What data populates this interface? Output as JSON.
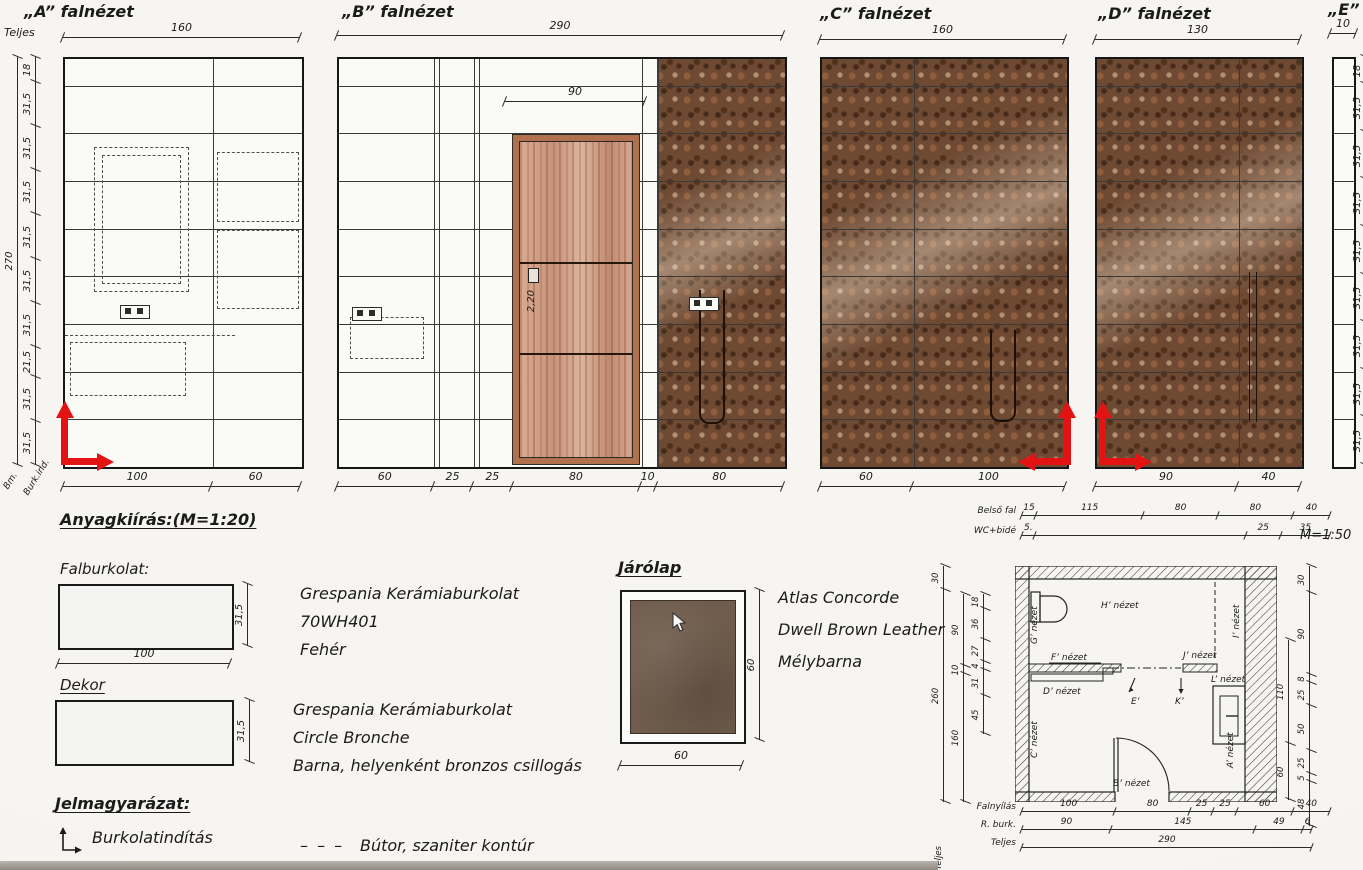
{
  "colors": {
    "accent_red": "#e31313",
    "mosaic_brown": "#6e4a33",
    "wood_tan": "#cf9c82",
    "floor_brown": "#6f5c4c",
    "ink": "#222222"
  },
  "views": {
    "a": {
      "title": "„A” falnézet",
      "teljes_label": "Teljes",
      "width_chain": [
        "160"
      ],
      "height_chain": [
        "270"
      ],
      "height_segments": [
        "18",
        "31,5",
        "31,5",
        "31,5",
        "31,5",
        "31,5",
        "31,5",
        "21,5",
        "31,5",
        "31,5"
      ],
      "bottom_chain": [
        "100",
        "60"
      ],
      "corner_label_1": "Bm.",
      "corner_label_2": "Burk.ind."
    },
    "b": {
      "title": "„B” falnézet",
      "width_chain": [
        "290"
      ],
      "door_width_chain": [
        "90"
      ],
      "door_height_label": "2,20",
      "bottom_chain": [
        "60",
        "25",
        "25",
        "80",
        "10",
        "80"
      ]
    },
    "c": {
      "title": "„C” falnézet",
      "width_chain": [
        "160"
      ],
      "bottom_chain": [
        "60",
        "100"
      ]
    },
    "d": {
      "title": "„D” falnézet",
      "width_chain": [
        "130"
      ],
      "bottom_chain": [
        "90",
        "40"
      ]
    },
    "e": {
      "title": "„E”",
      "width_chain": [
        "10"
      ],
      "height_segments": [
        "18",
        "31,5",
        "31,5",
        "31,5",
        "31,5",
        "31,5",
        "31,5",
        "31,5",
        "31,5"
      ]
    }
  },
  "materials": {
    "section_title": "Anyagkiírás:(M=1:20)",
    "wall_tile_label": "Falburkolat:",
    "wall_tile_width_chain": [
      "100"
    ],
    "wall_tile_height_chain": [
      "31,5"
    ],
    "wall_tile_desc": [
      "Grespania Kerámiaburkolat",
      "70WH401",
      "Fehér"
    ],
    "decor_label": "Dekor",
    "decor_height_chain": [
      "31,5"
    ],
    "decor_desc": [
      "Grespania Kerámiaburkolat",
      "Circle Bronche",
      "Barna, helyenként bronzos csillogás"
    ]
  },
  "floor_tile": {
    "title": "Járólap",
    "width_chain": [
      "60"
    ],
    "height_chain": [
      "60"
    ],
    "desc": [
      "Atlas Concorde",
      "Dwell Brown Leather",
      "Mélybarna"
    ]
  },
  "legend": {
    "title": "Jelmagyarázat:",
    "start_label": "Burkolatindítás",
    "dash_symbol": "– – –",
    "dash_label": "Bútor, szaniter kontúr"
  },
  "plan": {
    "scale": "M=1:50",
    "top_row_1_label": "Belső fal",
    "top_row_1": [
      "15",
      "115",
      "80",
      "80",
      "40"
    ],
    "top_row_2_label": "WC+bidé",
    "top_row_2": [
      "5.",
      "",
      "25",
      "35"
    ],
    "bottom_row_1_label": "Falnyílás",
    "bottom_row_1": [
      "100",
      "80",
      "25",
      "25",
      "60",
      "40"
    ],
    "bottom_row_2_label": "R. burk.",
    "bottom_row_2": [
      "90",
      "145",
      "49",
      "6"
    ],
    "bottom_row_3_label": "Teljes",
    "bottom_row_3": [
      "290"
    ],
    "side_label": "Teljes",
    "left_outer": [
      "30",
      "260"
    ],
    "left_mid": [
      "90",
      "10",
      "160"
    ],
    "left_inner": [
      "18",
      "36",
      "27",
      "4",
      "31",
      "45"
    ],
    "right_outer": [
      "30",
      "90",
      "8",
      "25",
      "50",
      "25",
      "5",
      "48"
    ],
    "right_inner": [
      "110",
      "60"
    ],
    "labels": {
      "h": "H’ nézet",
      "g": "G’ nézet",
      "f": "F’ nézet",
      "i": "I’ nézet",
      "j": "J’ nézet",
      "d": "D’ nézet",
      "e": "E’",
      "k": "K’",
      "l": "L’ nézet",
      "c": "C’ nézet",
      "b": "B’ nézet",
      "a": "A’ nézet"
    }
  }
}
